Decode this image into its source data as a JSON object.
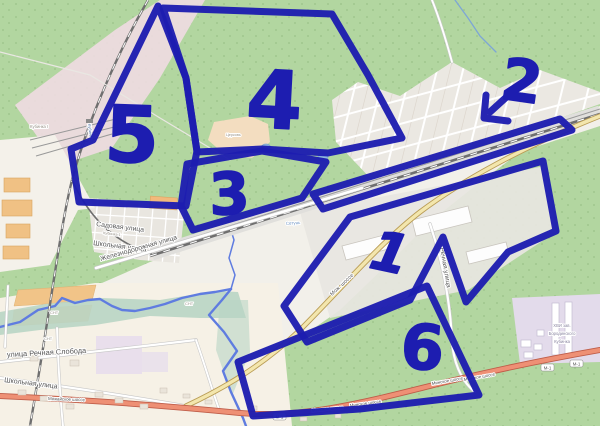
{
  "map": {
    "style": "openstreetmap",
    "labels": {
      "sadovaya_ulitsa": "Садовая улица",
      "shkolnaya_ulitsa_center": "Школьная улица",
      "kubinka_settlement": "Кубинка-1",
      "zheleznodorozhnaya_ulitsa": "Железнодорожная улица",
      "ulitsa_rechnaya_sloboda": "улица Речная Слобода",
      "shkolnaya_ulitsa_sw": "Школьная улица",
      "rechnaya_ulitsa": "Речная улица",
      "mozh_shosse_abbrev": "Мож. шоссе",
      "mozhayskoye_shosse_sw": "Можайское шоссе",
      "minskoye_shosse": [
        "Минское шоссе",
        "Минское шоссе",
        "Минское шоссе",
        "Минское шоссе"
      ],
      "m1_refs": [
        "М-1",
        "М-1",
        "М-1"
      ],
      "station": "Кубинка I",
      "station_vertical": "Кубинка",
      "river": "Сетунь",
      "museum_area": [
        "ХВИ зав.",
        "Бородинского",
        "Кубинка"
      ],
      "church": "Церковь",
      "snt": [
        "СНТ",
        "СНТ",
        "СНТ"
      ]
    },
    "colors": {
      "forest": "#b2d6a0",
      "residential_grid": "#ebe8e2",
      "industrial": "#e8e6e1",
      "museum_lavender": "#e3dbeb",
      "railway_landuse": "#efdce2",
      "town": "#f6f1e6",
      "water": "#5f7ce0",
      "trunk_road": "#ee9075",
      "secondary_road": "#f3e6ad"
    }
  },
  "annotations": {
    "tool_color": "#1d1db0",
    "digits": {
      "one": "1",
      "two": "2",
      "three": "3",
      "four": "4",
      "five": "5",
      "six": "6"
    },
    "regions_marked": 6,
    "arrow_note": "arrow from digit 2 pointing to railway-side strip"
  }
}
